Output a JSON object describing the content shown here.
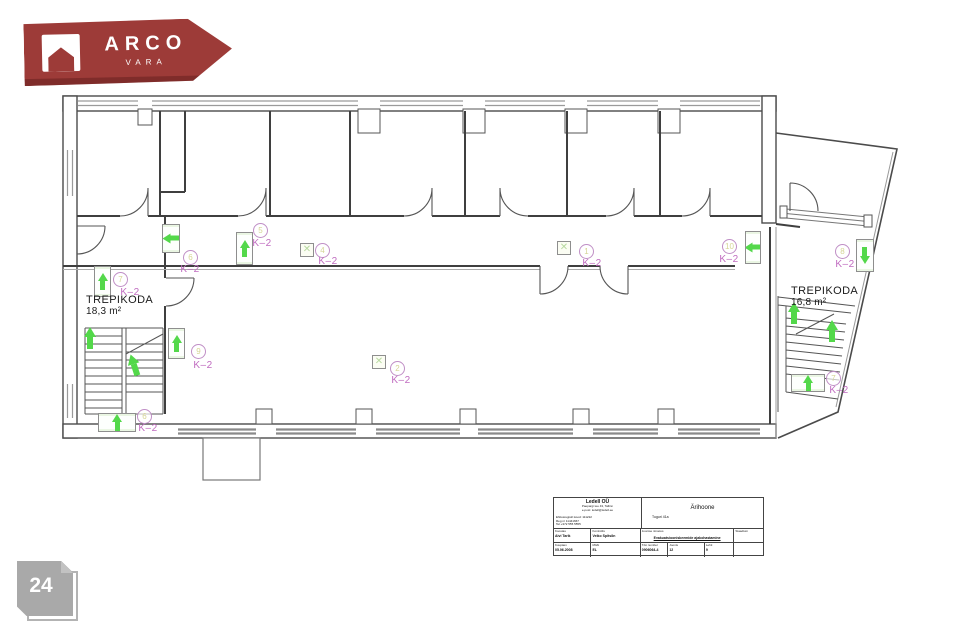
{
  "colors": {
    "green": "#53d84a",
    "pink": "#c06cc0",
    "maroon": "#9d3b38",
    "badge": "#a9a9a9"
  },
  "logo": {
    "brand": "ARCO",
    "sub": "VARA"
  },
  "badge": {
    "number": "24"
  },
  "plan": {
    "k2_text": "K–2",
    "rooms": [
      {
        "name": "TREPIKODA",
        "area": "18,3 m²"
      },
      {
        "name": "TREPIKODA",
        "area": "16,8 m²"
      }
    ],
    "markers": [
      {
        "t": "abox",
        "x": 94,
        "y": 266,
        "w": 17,
        "h": 31,
        "dir": "up"
      },
      {
        "t": "abox",
        "x": 162,
        "y": 224,
        "w": 18,
        "h": 29,
        "dir": "left"
      },
      {
        "t": "abox",
        "x": 236,
        "y": 232,
        "w": 17,
        "h": 33,
        "dir": "up"
      },
      {
        "t": "abox",
        "x": 168,
        "y": 328,
        "w": 17,
        "h": 31,
        "dir": "up"
      },
      {
        "t": "abox",
        "x": 98,
        "y": 413,
        "w": 38,
        "h": 19,
        "dir": "up"
      },
      {
        "t": "abox",
        "x": 745,
        "y": 231,
        "w": 16,
        "h": 33,
        "dir": "left"
      },
      {
        "t": "abox",
        "x": 856,
        "y": 239,
        "w": 18,
        "h": 33,
        "dir": "down"
      },
      {
        "t": "abox",
        "x": 791,
        "y": 374,
        "w": 34,
        "h": 18,
        "dir": "up"
      },
      {
        "t": "arrow",
        "x": 84,
        "y": 327,
        "dir": "up"
      },
      {
        "t": "arrow",
        "x": 128,
        "y": 354,
        "dir": "up-tilt"
      },
      {
        "t": "arrow",
        "x": 788,
        "y": 302,
        "dir": "up"
      },
      {
        "t": "arrow",
        "x": 826,
        "y": 320,
        "dir": "up"
      },
      {
        "t": "xsq",
        "x": 300,
        "y": 243
      },
      {
        "t": "xsq",
        "x": 557,
        "y": 241
      },
      {
        "t": "xsq",
        "x": 372,
        "y": 355
      },
      {
        "t": "circle",
        "x": 113,
        "y": 272,
        "n": "7"
      },
      {
        "t": "circle",
        "x": 183,
        "y": 250,
        "n": "6"
      },
      {
        "t": "circle",
        "x": 253,
        "y": 223,
        "n": "5"
      },
      {
        "t": "circle",
        "x": 315,
        "y": 243,
        "n": "4"
      },
      {
        "t": "circle",
        "x": 579,
        "y": 244,
        "n": "1"
      },
      {
        "t": "circle",
        "x": 722,
        "y": 239,
        "n": "10"
      },
      {
        "t": "circle",
        "x": 835,
        "y": 244,
        "n": "8"
      },
      {
        "t": "circle",
        "x": 191,
        "y": 344,
        "n": "9"
      },
      {
        "t": "circle",
        "x": 390,
        "y": 361,
        "n": "2"
      },
      {
        "t": "circle",
        "x": 137,
        "y": 409,
        "n": "6"
      },
      {
        "t": "circle",
        "x": 826,
        "y": 371,
        "n": "7"
      },
      {
        "t": "k2",
        "x": 130,
        "y": 287
      },
      {
        "t": "k2",
        "x": 190,
        "y": 264
      },
      {
        "t": "k2",
        "x": 262,
        "y": 238
      },
      {
        "t": "k2",
        "x": 328,
        "y": 256
      },
      {
        "t": "k2",
        "x": 592,
        "y": 258
      },
      {
        "t": "k2",
        "x": 729,
        "y": 254
      },
      {
        "t": "k2",
        "x": 845,
        "y": 259
      },
      {
        "t": "k2",
        "x": 203,
        "y": 360
      },
      {
        "t": "k2",
        "x": 401,
        "y": 375
      },
      {
        "t": "k2",
        "x": 148,
        "y": 423
      },
      {
        "t": "k2",
        "x": 839,
        "y": 385
      }
    ]
  },
  "titleblock": {
    "company": "Ledell OÜ",
    "company_sub1": "Paepargi tee 43, Tallinn",
    "company_sub2": "e-post: ledell@ledell.ee",
    "note1": "Ehitusregistri kood: 111222",
    "note2": "Reg nr 11441667",
    "note3": "Tel +372 555 5555",
    "project": "Ärihoone",
    "project_sub": "Tuguri 41a",
    "koostas_label": "Koostas",
    "koostas_value": "Aivi Tarik",
    "kontrollis_label": "Kontrollis",
    "kontrollis_value": "Veiko Spitsõn",
    "joonis_label": "Joonise nimetus",
    "joonis_value": "Evakuatsiooniskeemide ajakohastamine",
    "staadium_label": "Staadium",
    "kuupaev_label": "Kuupäev",
    "kuupaev_value": "05.06.2008",
    "moot_label": "Mõõt",
    "moot_value": "EL",
    "toonr_label": "Töö number",
    "toonr_value": "0906064-4",
    "joonisnr_label": "Joonis",
    "joonisnr_value": "12",
    "lehti_label": "Lehti",
    "lehti_value": "9"
  }
}
